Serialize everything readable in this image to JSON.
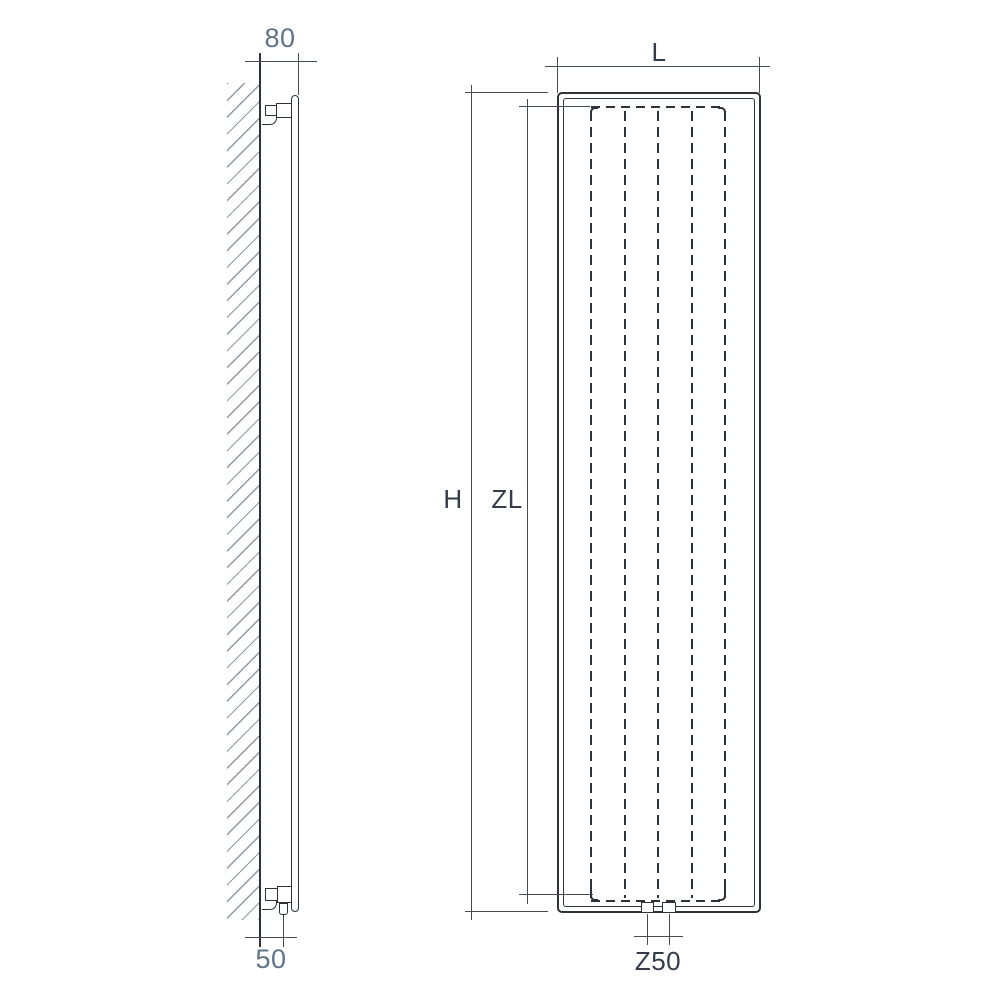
{
  "drawing": {
    "title": "vertical-radiator-dimension-drawing",
    "side_view": {
      "dim_depth_label": "80",
      "dim_wall_offset_label": "50"
    },
    "front_view": {
      "dim_width_label": "L",
      "dim_height_label": "H",
      "dim_axis_height_label": "ZL",
      "dim_connection_label": "Z50"
    },
    "colors": {
      "outline": "#2e333a",
      "dimension_line": "#464c55",
      "hatch": "#8f97a0",
      "label_gray_blue": "#5f7486",
      "label_dark": "#343b49",
      "background": "#ffffff"
    }
  }
}
